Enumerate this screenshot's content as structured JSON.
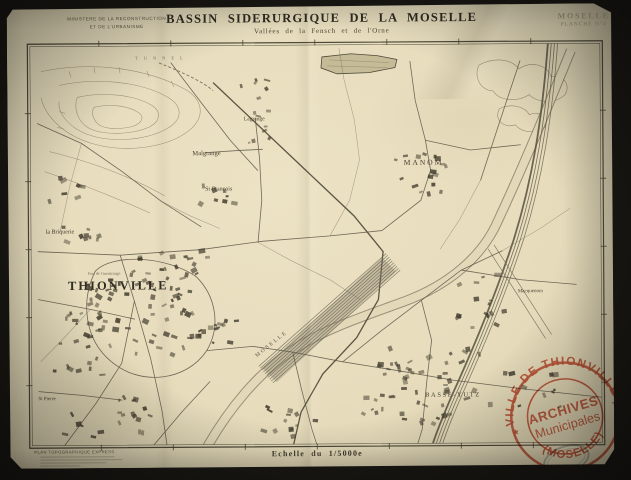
{
  "document": {
    "ministry_line1": "MINISTERE DE LA RECONSTRUCTION",
    "ministry_line2": "ET DE L'URBANISME",
    "title": "BASSIN SIDERURGIQUE DE LA MOSELLE",
    "subtitle": "Vallées de la Fensch et de l'Orne",
    "corner_region": "MOSELLE",
    "corner_sheet": "PLANCHE N°4",
    "scale_label": "Echelle du 1/5000e",
    "credit_label": "PLAN TOPOGRAPHIQUE EXPRESS"
  },
  "map": {
    "labels": [
      {
        "id": "tunnel",
        "text": "TUNNEL",
        "x": 163,
        "y": 57,
        "size": 4.4,
        "ls": 6,
        "color": "#77705c"
      },
      {
        "id": "lagrange",
        "text": "Lagrange",
        "x": 255,
        "y": 119,
        "size": 5.5
      },
      {
        "id": "malgrange",
        "text": "Malgrange",
        "x": 207,
        "y": 153,
        "size": 6.5
      },
      {
        "id": "st-francois",
        "text": "St François",
        "x": 219,
        "y": 189,
        "size": 6
      },
      {
        "id": "fort-de-guentrange",
        "text": "Fort de Guentrange",
        "x": 104,
        "y": 272,
        "size": 4.2,
        "color": "#6e6754"
      },
      {
        "id": "thionville",
        "text": "THIONVILLE",
        "x": 118,
        "y": 285,
        "size": 12.5,
        "ls": 2,
        "weight": "bold",
        "color": "#312d24"
      },
      {
        "id": "la-briquerie",
        "text": "la Briquerie",
        "x": 60,
        "y": 231,
        "size": 6
      },
      {
        "id": "st-pierre",
        "text": "St Pierre",
        "x": 46,
        "y": 398,
        "size": 5
      },
      {
        "id": "manom",
        "text": "MANOM",
        "x": 424,
        "y": 163,
        "size": 7.5,
        "ls": 2
      },
      {
        "id": "basse-yutz",
        "text": "BASSE-YUTZ",
        "x": 452,
        "y": 396,
        "size": 6.5,
        "ls": 1.6
      },
      {
        "id": "moselle-river",
        "text": "MOSELLE",
        "x": 271,
        "y": 344,
        "size": 5.5,
        "ls": 2,
        "rot": -38,
        "color": "#5d5646"
      },
      {
        "id": "macquenom",
        "text": "Macquenom",
        "x": 530,
        "y": 293,
        "size": 5
      }
    ]
  },
  "stamp": {
    "arc_top": "VILLE DE THIONVILLE",
    "center_line1": "ARCHIVES",
    "center_line2": "Municipales",
    "arc_bottom": "(MOSELLE)",
    "star_left": "★",
    "star_right": "★",
    "color": "#c94a30"
  }
}
